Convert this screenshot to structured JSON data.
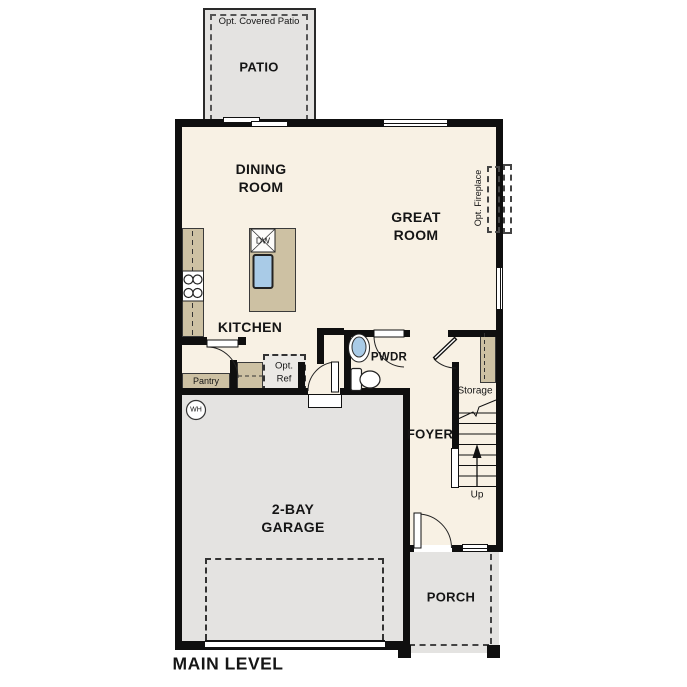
{
  "plan_title": "MAIN LEVEL",
  "colors": {
    "wall": "#0f0f0f",
    "interior_floor": "#f8f1e4",
    "concrete_floor": "#e4e3e1",
    "cabinet_tan": "#cdc1a3",
    "fixture_blue": "#a9cbe7",
    "text": "#151515"
  },
  "rooms": {
    "patio": "PATIO",
    "dining": "DINING\nROOM",
    "great": "GREAT\nROOM",
    "kitchen": "KITCHEN",
    "powder": "PWDR",
    "foyer": "FOYER",
    "garage": "2-BAY\nGARAGE",
    "porch": "PORCH",
    "storage": "Storage",
    "pantry": "Pantry"
  },
  "annotations": {
    "opt_covered_patio": "Opt. Covered Patio",
    "opt_fireplace": "Opt. Fireplace",
    "opt_ref": "Opt.\nRef",
    "dishwasher": "DW",
    "water_heater": "WH",
    "up": "Up",
    "main_level": "MAIN LEVEL"
  }
}
